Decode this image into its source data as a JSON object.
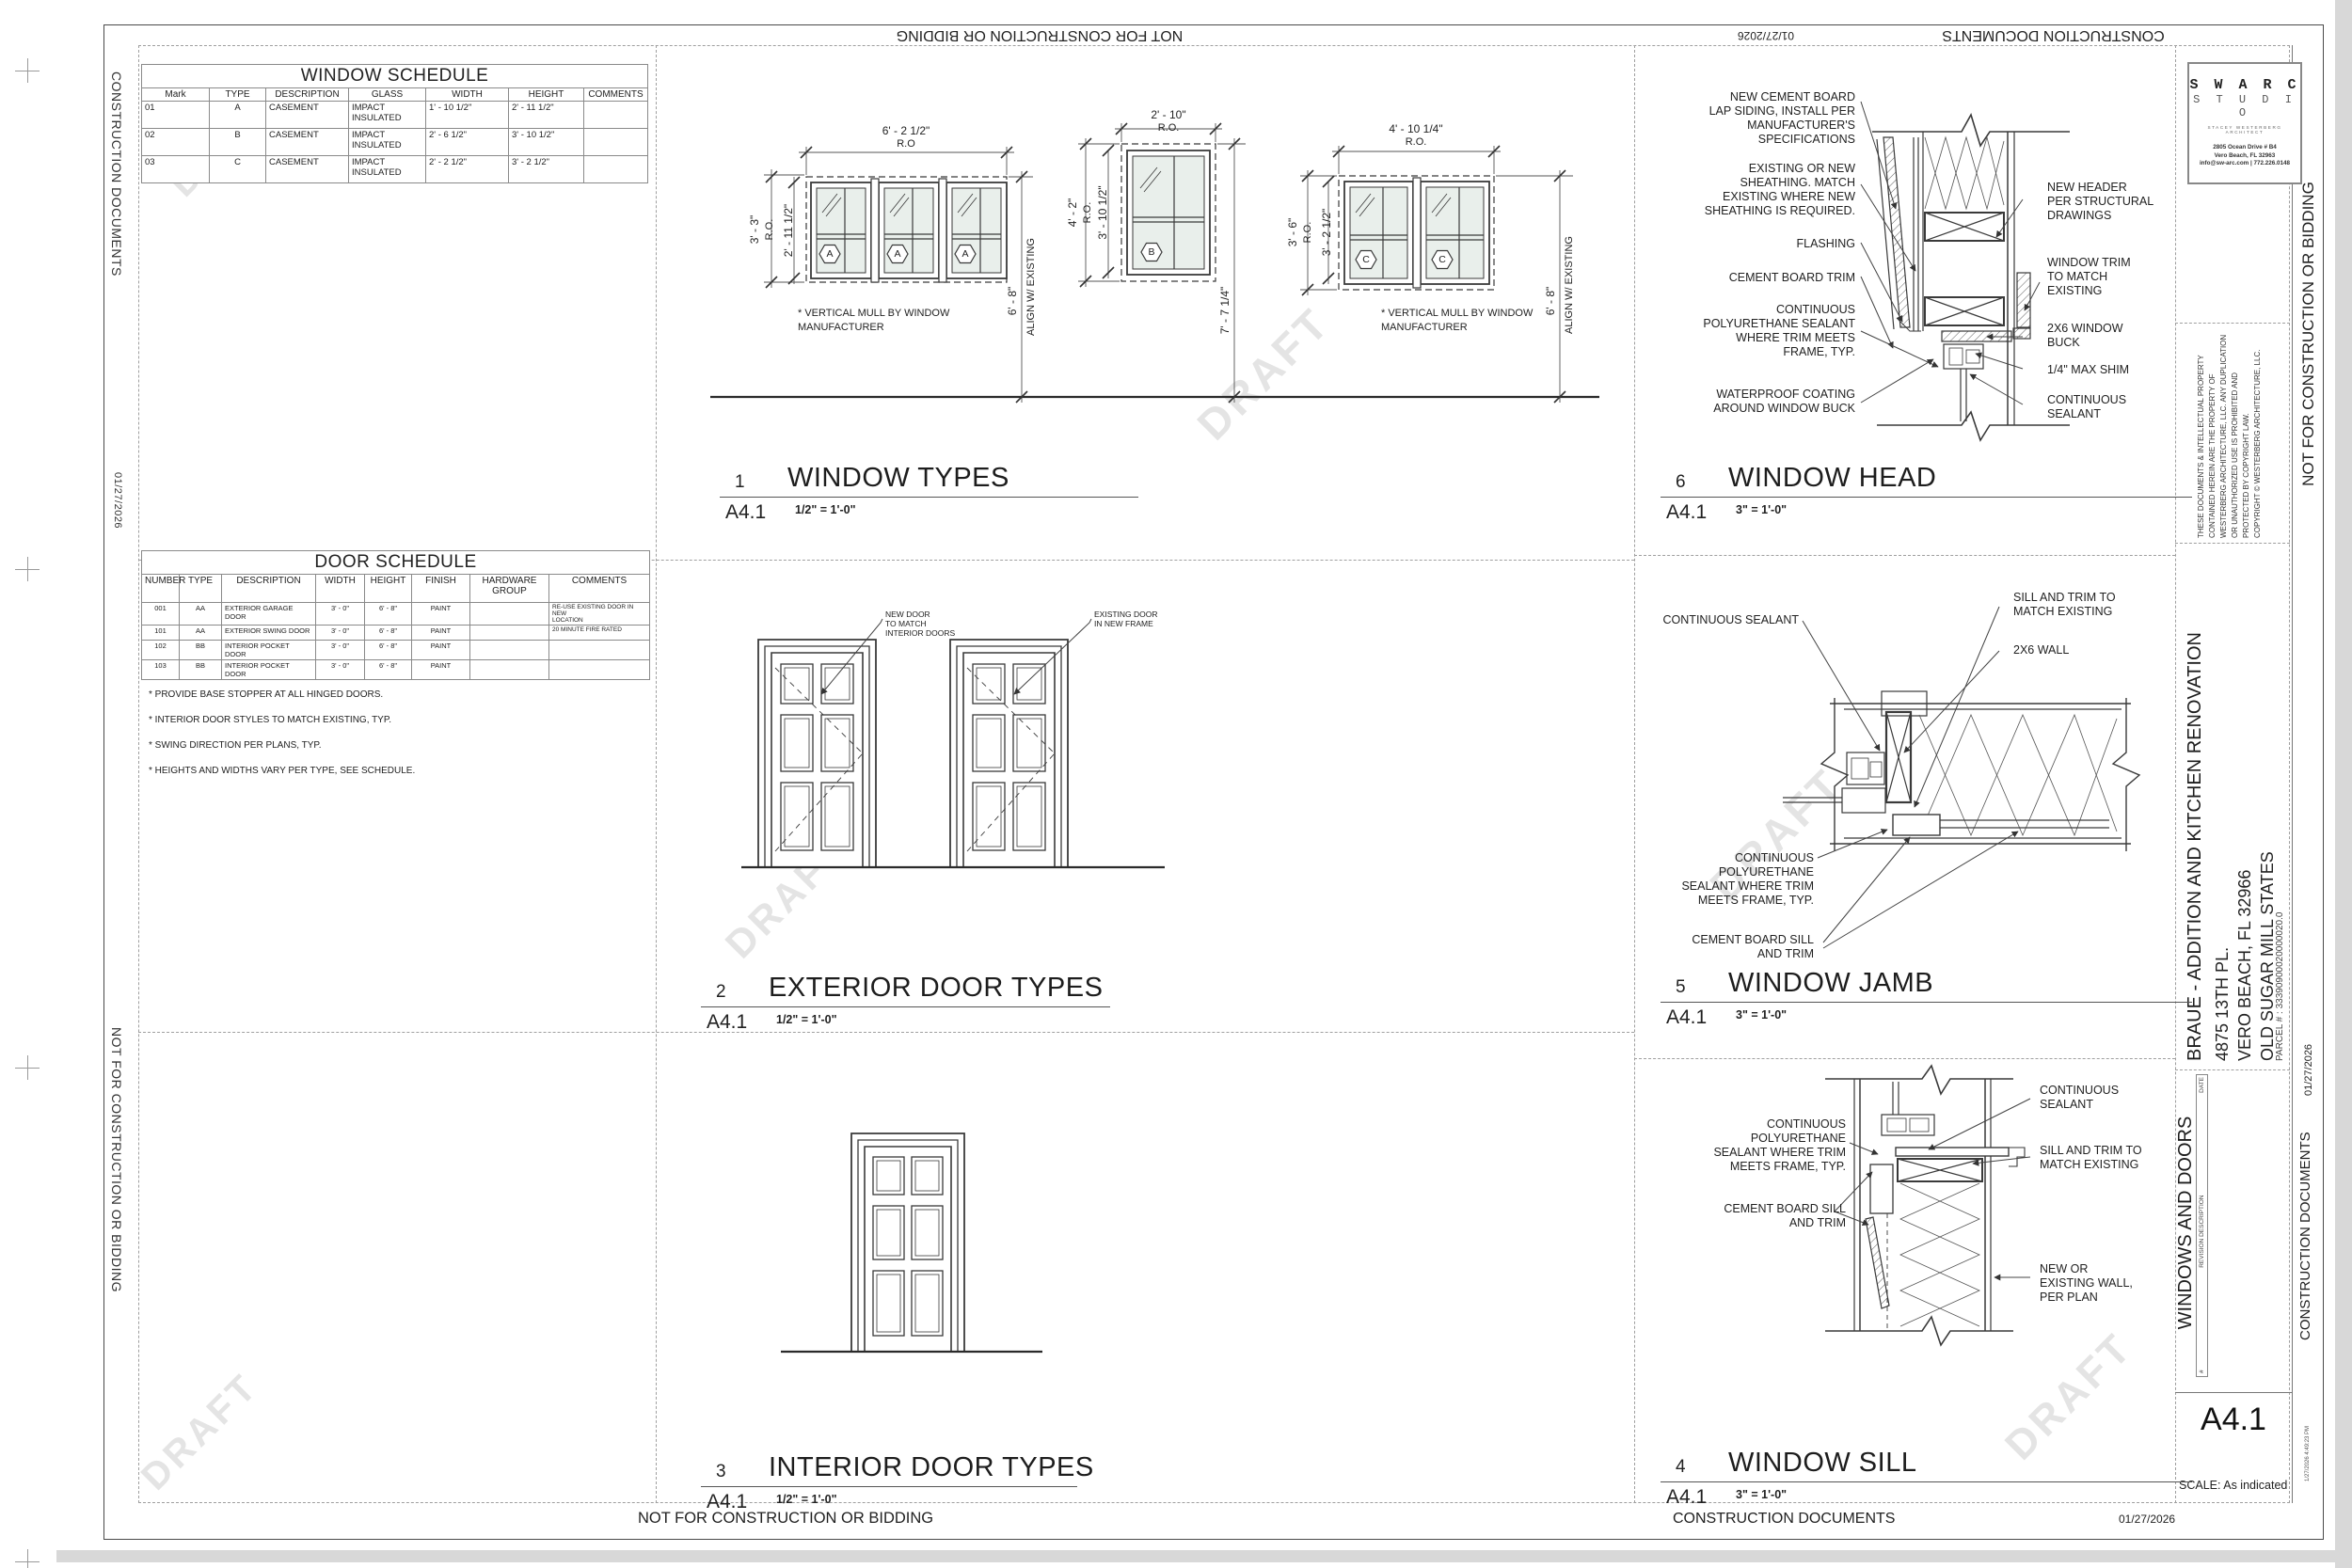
{
  "sheet": {
    "number": "A4.1",
    "scale": "SCALE: As indicated",
    "title": "WINDOWS AND DOORS",
    "phase": "CONSTRUCTION DOCUMENTS",
    "date": "01/27/2026",
    "not_for": "NOT FOR CONSTRUCTION OR BIDDING",
    "timestamp": "1/27/2026 4:49:23 PM",
    "watermark": "DRAFT"
  },
  "firm": {
    "name_line1": "S W A R C",
    "name_line2": "S T U D I O",
    "tagline": "STACEY WESTERBERG  ARCHITECT",
    "address1": "2805 Ocean Drive # B4",
    "address2": "Vero Beach, FL 32963",
    "contact": "info@sw-arc.com | 772.226.0148"
  },
  "legal": {
    "copyright": "THESE DOCUMENTS & INTELLECTUAL PROPERTY\nCONTAINED HEREIN ARE THE PROPERTY OF\nWESTERBERG ARCHITECTURE, LLC. ANY DUPLICATION\nOR UNAUTHORIZED USE IS PROHIBITED AND\nPROTECTED BY COPYRIGHT LAW.\nCOPYRIGHT © WESTERBERG ARCHITECTURE, LLC."
  },
  "project": {
    "name": "BRAUE - ADDITION AND KITCHEN RENOVATION",
    "address1": "4875 13TH PL.",
    "address2": "VERO BEACH, FL 32966",
    "subdivision": "OLD SUGAR MILL STATES",
    "parcel": "PARCEL # :   33390900020000020.0"
  },
  "revision_table": {
    "col_num": "#",
    "col_desc": "REVISION DESCRIPTION",
    "col_date": "DATE"
  },
  "window_schedule": {
    "title": "WINDOW SCHEDULE",
    "columns": [
      "Mark",
      "TYPE",
      "DESCRIPTION",
      "GLASS",
      "WIDTH",
      "HEIGHT",
      "COMMENTS"
    ],
    "rows": [
      [
        "01",
        "A",
        "CASEMENT",
        "IMPACT\nINSULATED",
        "1' - 10 1/2\"",
        "2' - 11 1/2\"",
        ""
      ],
      [
        "02",
        "B",
        "CASEMENT",
        "IMPACT\nINSULATED",
        "2' - 6 1/2\"",
        "3' - 10 1/2\"",
        ""
      ],
      [
        "03",
        "C",
        "CASEMENT",
        "IMPACT\nINSULATED",
        "2' - 2 1/2\"",
        "3' - 2 1/2\"",
        ""
      ]
    ]
  },
  "door_schedule": {
    "title": "DOOR SCHEDULE",
    "columns": [
      "NUMBER",
      "TYPE",
      "DESCRIPTION",
      "WIDTH",
      "HEIGHT",
      "FINISH",
      "HARDWARE\nGROUP",
      "COMMENTS"
    ],
    "rows": [
      [
        "001",
        "AA",
        "EXTERIOR GARAGE DOOR",
        "3' - 0\"",
        "6' - 8\"",
        "PAINT",
        "",
        "RE-USE EXISTING DOOR IN NEW\nLOCATION"
      ],
      [
        "101",
        "AA",
        "EXTERIOR SWING DOOR",
        "3' - 0\"",
        "6' - 8\"",
        "PAINT",
        "",
        "20 MINUTE FIRE RATED"
      ],
      [
        "102",
        "BB",
        "INTERIOR POCKET DOOR",
        "3' - 0\"",
        "6' - 8\"",
        "PAINT",
        "",
        ""
      ],
      [
        "103",
        "BB",
        "INTERIOR POCKET DOOR",
        "3' - 0\"",
        "6' - 8\"",
        "PAINT",
        "",
        ""
      ]
    ],
    "notes_title": "INTERIOR DOOR NOTES",
    "notes": [
      "* PROVIDE BASE STOPPER AT ALL HINGED DOORS.",
      "* INTERIOR DOOR STYLES TO MATCH EXISTING, TYP.",
      "* SWING DIRECTION PER PLANS, TYP.",
      "* HEIGHTS AND WIDTHS VARY PER TYPE, SEE SCHEDULE."
    ]
  },
  "window_types": {
    "a": {
      "ro_w": "6' - 2 1/2\"",
      "ro_lbl": "R.O",
      "ro_h": "3' - 3\"",
      "ro_lbl2": "R.O.",
      "unit_h": "2' - 11 1/2\"",
      "align_dim": "6' - 8\"",
      "align_lbl": "ALIGN W/ EXISTING",
      "badge": "A"
    },
    "b": {
      "ro_w": "2' - 10\"",
      "ro_lbl": "R.O.",
      "ro_h": "4' - 2\"",
      "ro_lbl2": "R.O.",
      "unit_h": "3' - 10 1/2\"",
      "head_dim": "7' - 7 1/4\"",
      "badge": "B"
    },
    "c": {
      "ro_w": "4' - 10 1/4\"",
      "ro_lbl": "R.O.",
      "ro_h": "3' - 6\"",
      "ro_lbl2": "R.O.",
      "unit_h": "3' - 2 1/2\"",
      "align_dim": "6' - 8\"",
      "align_lbl": "ALIGN W/ EXISTING",
      "badge": "C"
    },
    "mull_note": "* VERTICAL MULL BY WINDOW\nMANUFACTURER"
  },
  "door_types": {
    "new_door": "NEW DOOR\nTO MATCH\nINTERIOR DOORS",
    "existing_door": "EXISTING DOOR\nIN NEW FRAME"
  },
  "head": {
    "l0": "NEW CEMENT BOARD\nLAP SIDING, INSTALL PER\nMANUFACTURER'S\nSPECIFICATIONS",
    "l1": "EXISTING OR NEW\nSHEATHING.  MATCH\nEXISTING WHERE NEW\nSHEATHING IS REQUIRED.",
    "l2": "FLASHING",
    "l3": "CEMENT BOARD TRIM",
    "l4": "CONTINUOUS\nPOLYURETHANE SEALANT\nWHERE TRIM MEETS\nFRAME, TYP.",
    "l5": "WATERPROOF COATING\nAROUND WINDOW BUCK",
    "r0": "NEW HEADER\nPER STRUCTURAL\nDRAWINGS",
    "r1": "WINDOW TRIM\nTO MATCH\nEXISTING",
    "r2": "2X6 WINDOW\nBUCK",
    "r3": "1/4\" MAX SHIM",
    "r4": "CONTINUOUS\nSEALANT"
  },
  "jamb": {
    "l0": "CONTINUOUS SEALANT",
    "l1": "CONTINUOUS\nPOLYURETHANE\nSEALANT WHERE TRIM\nMEETS FRAME, TYP.",
    "l2": "CEMENT BOARD SILL\nAND TRIM",
    "r0": "SILL AND TRIM TO\nMATCH EXISTING",
    "r1": "2X6 WALL"
  },
  "sill": {
    "l0": "CONTINUOUS\nPOLYURETHANE\nSEALANT WHERE TRIM\nMEETS FRAME, TYP.",
    "l1": "CEMENT BOARD SILL\nAND TRIM",
    "r0": "CONTINUOUS\nSEALANT",
    "r1": "SILL AND TRIM TO\nMATCH EXISTING",
    "r2": "NEW OR\nEXISTING WALL,\nPER PLAN"
  },
  "viewports": {
    "window_types": {
      "num": "1",
      "ref": "A4.1",
      "title": "WINDOW TYPES",
      "scale": "1/2\" = 1'-0\""
    },
    "exterior_doors": {
      "num": "2",
      "ref": "A4.1",
      "title": "EXTERIOR DOOR TYPES",
      "scale": "1/2\" = 1'-0\""
    },
    "interior_doors": {
      "num": "3",
      "ref": "A4.1",
      "title": "INTERIOR DOOR TYPES",
      "scale": "1/2\" = 1'-0\""
    },
    "window_sill": {
      "num": "4",
      "ref": "A4.1",
      "title": "WINDOW SILL",
      "scale": "3\" = 1'-0\""
    },
    "window_jamb": {
      "num": "5",
      "ref": "A4.1",
      "title": "WINDOW JAMB",
      "scale": "3\" = 1'-0\""
    },
    "window_head": {
      "num": "6",
      "ref": "A4.1",
      "title": "WINDOW HEAD",
      "scale": "3\" = 1'-0\""
    }
  }
}
